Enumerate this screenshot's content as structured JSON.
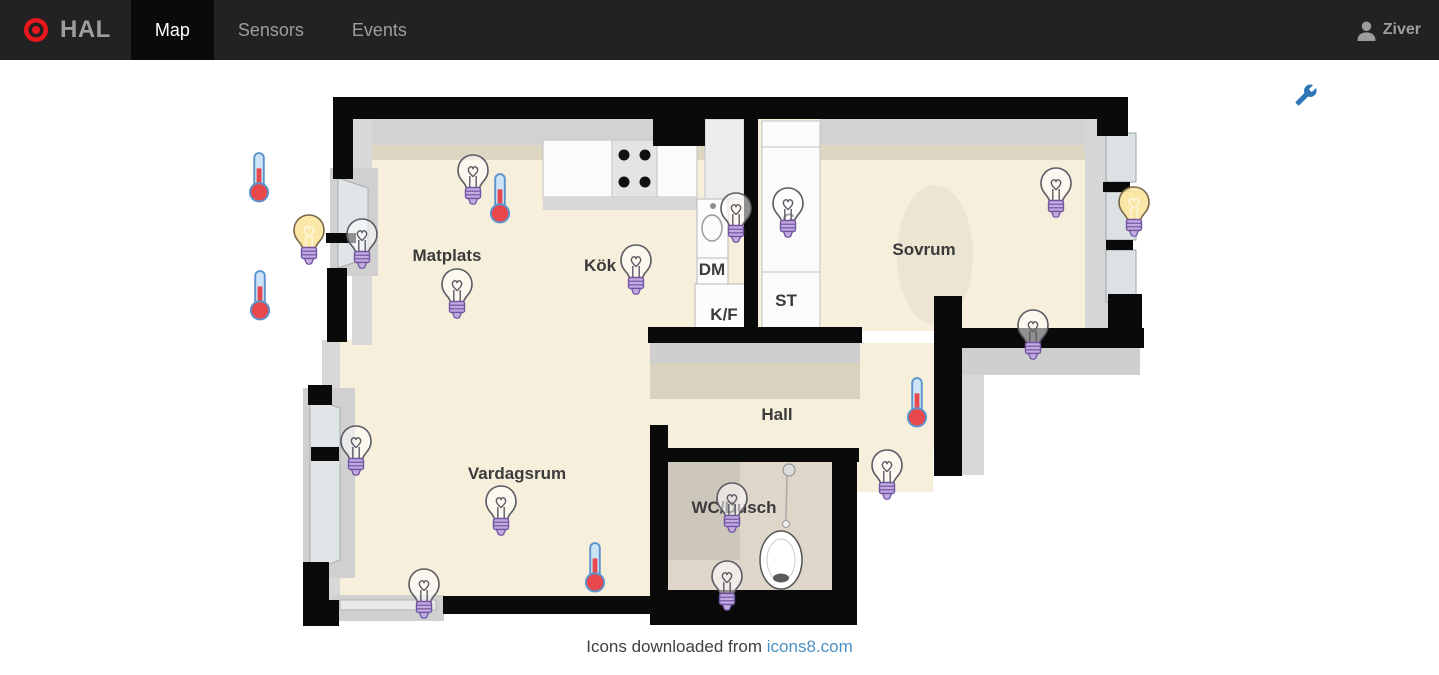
{
  "navbar": {
    "brand": "HAL",
    "tabs": [
      {
        "label": "Map",
        "active": true
      },
      {
        "label": "Sensors",
        "active": false
      },
      {
        "label": "Events",
        "active": false
      }
    ],
    "user_name": "Ziver"
  },
  "map": {
    "room_labels": [
      {
        "text": "Matplats",
        "x": 447,
        "y": 256
      },
      {
        "text": "Kök",
        "x": 600,
        "y": 266
      },
      {
        "text": "Sovrum",
        "x": 924,
        "y": 250
      },
      {
        "text": "Hall",
        "x": 777,
        "y": 415
      },
      {
        "text": "Vardagsrum",
        "x": 517,
        "y": 474
      },
      {
        "text": "WC/Dusch",
        "x": 734,
        "y": 508
      }
    ],
    "appliance_labels": [
      {
        "text": "DM",
        "x": 712,
        "y": 270
      },
      {
        "text": "K/F",
        "x": 724,
        "y": 315
      },
      {
        "text": "ST",
        "x": 786,
        "y": 301
      },
      {
        "text": "G",
        "x": 789,
        "y": 220
      }
    ],
    "sensors": [
      {
        "type": "thermometer",
        "x": 259,
        "y": 177
      },
      {
        "type": "bulb-on",
        "x": 309,
        "y": 241
      },
      {
        "type": "bulb-off",
        "x": 362,
        "y": 245
      },
      {
        "type": "thermometer",
        "x": 260,
        "y": 295
      },
      {
        "type": "bulb-off",
        "x": 473,
        "y": 181
      },
      {
        "type": "thermometer",
        "x": 500,
        "y": 198
      },
      {
        "type": "bulb-off",
        "x": 457,
        "y": 295
      },
      {
        "type": "bulb-off",
        "x": 636,
        "y": 271
      },
      {
        "type": "bulb-off",
        "x": 736,
        "y": 219
      },
      {
        "type": "bulb-off",
        "x": 788,
        "y": 214
      },
      {
        "type": "bulb-off",
        "x": 1056,
        "y": 194
      },
      {
        "type": "bulb-on",
        "x": 1134,
        "y": 213
      },
      {
        "type": "bulb-off",
        "x": 1033,
        "y": 336
      },
      {
        "type": "thermometer",
        "x": 917,
        "y": 402
      },
      {
        "type": "bulb-off",
        "x": 887,
        "y": 476
      },
      {
        "type": "bulb-off",
        "x": 356,
        "y": 452
      },
      {
        "type": "bulb-off",
        "x": 501,
        "y": 512
      },
      {
        "type": "bulb-off",
        "x": 732,
        "y": 509
      },
      {
        "type": "thermometer",
        "x": 595,
        "y": 567
      },
      {
        "type": "bulb-off",
        "x": 424,
        "y": 595
      },
      {
        "type": "bulb-off",
        "x": 727,
        "y": 587
      }
    ]
  },
  "footer": {
    "caption": "Icons downloaded from",
    "link_text": "icons8.com"
  },
  "colors": {
    "navbar_bg": "#222222",
    "active_tab_bg": "#0a0a0a",
    "brand_red": "#e8171d",
    "floor_beige": "#f6efdb",
    "wall_black": "#0a0a0a",
    "bulb_base_purple": "#c3abe0",
    "bulb_on_yellow": "#fbe7a3",
    "thermometer_red": "#e8474b",
    "wrench_blue": "#2e75b6",
    "link_blue": "#4a90c4"
  }
}
